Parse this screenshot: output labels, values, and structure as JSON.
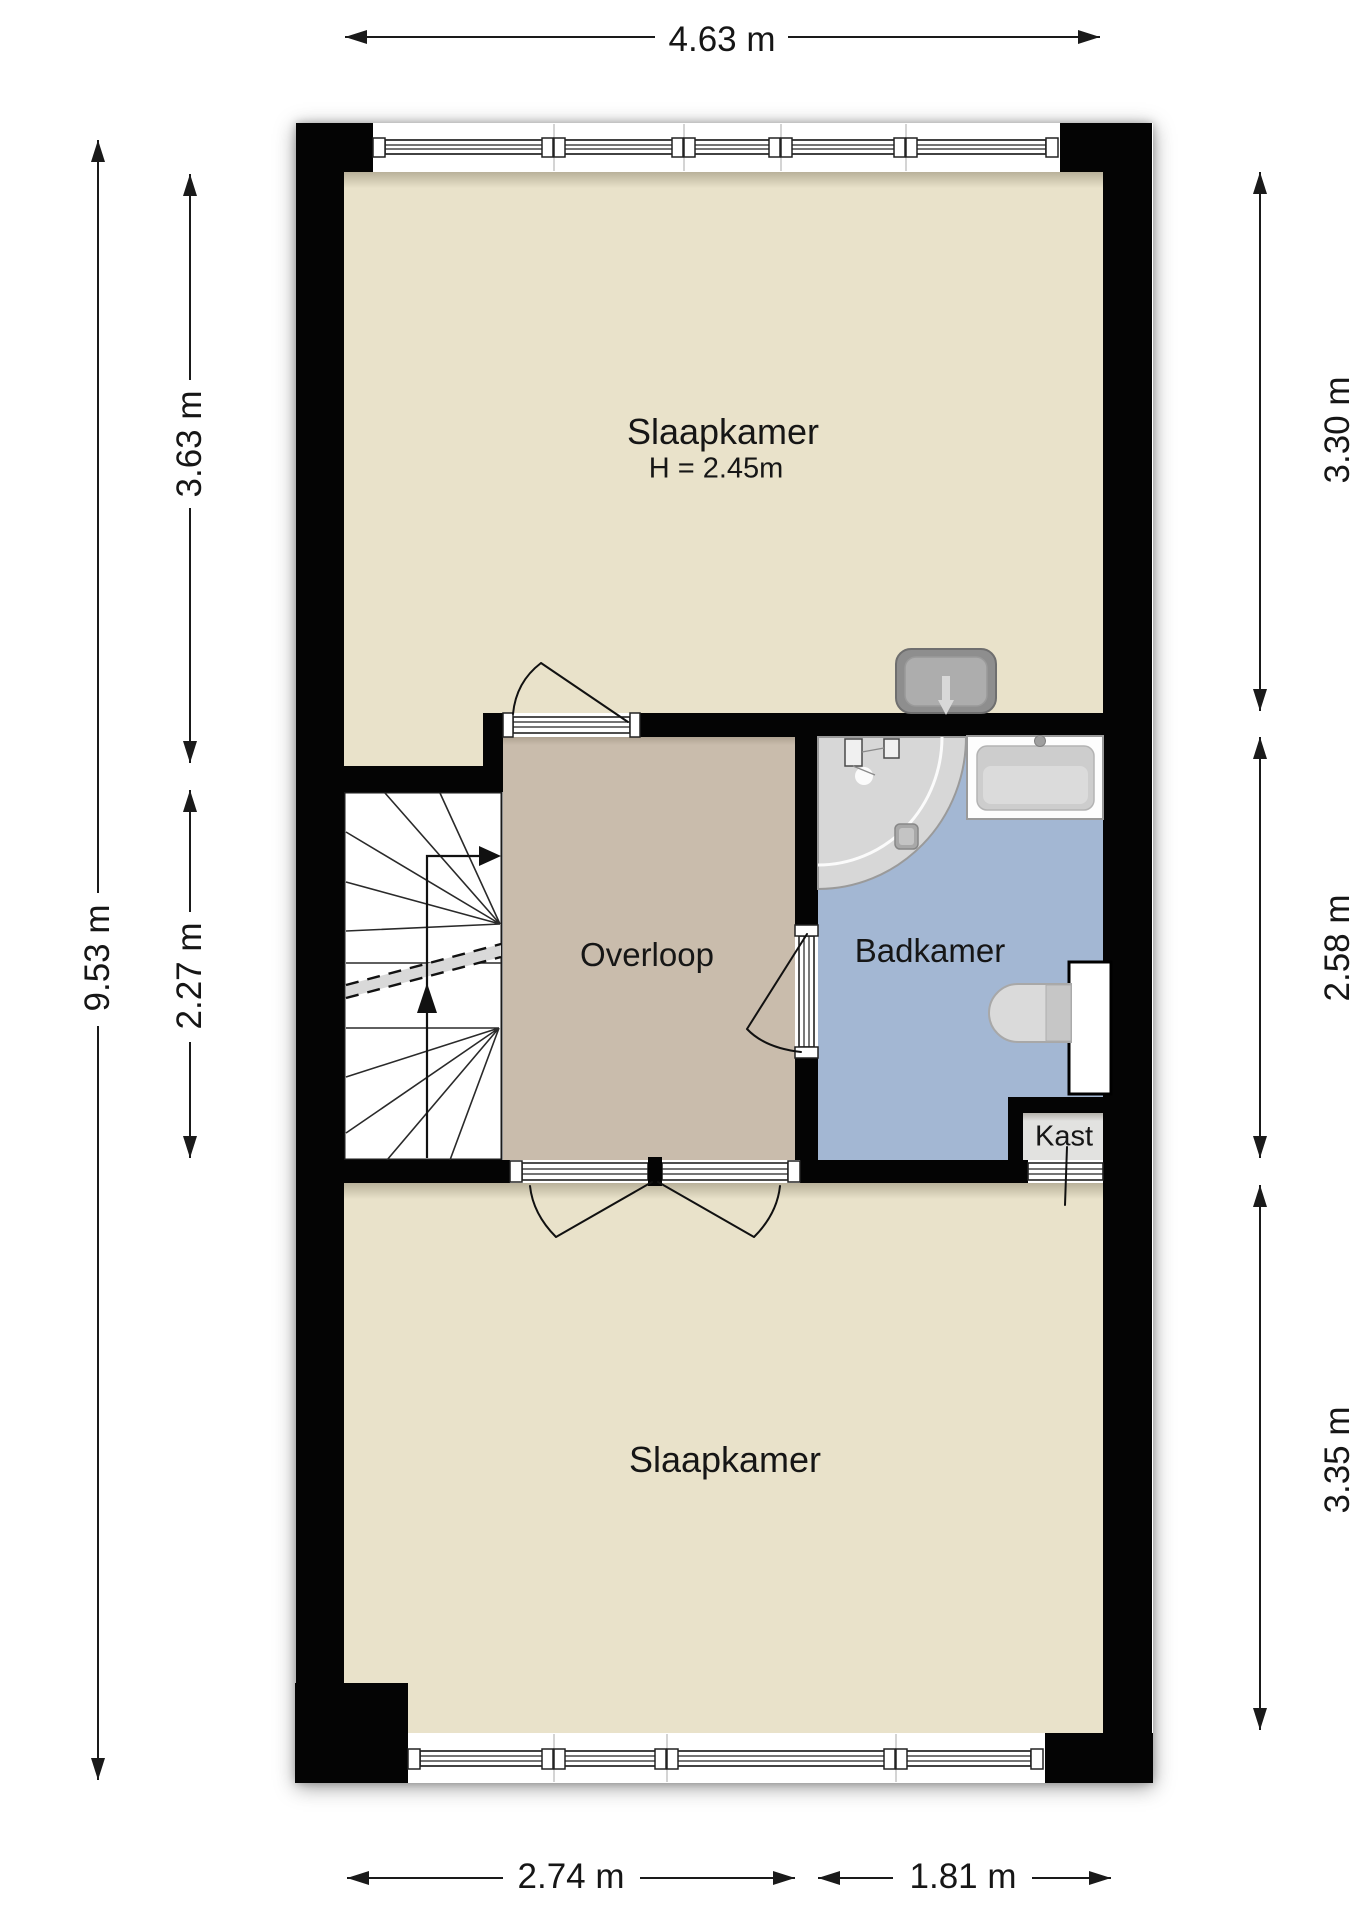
{
  "plan": {
    "rooms": {
      "slaapkamer_top": {
        "label": "Slaapkamer",
        "height_note": "H = 2.45m"
      },
      "overloop": {
        "label": "Overloop"
      },
      "badkamer": {
        "label": "Badkamer"
      },
      "kast": {
        "label": "Kast"
      },
      "slaapkamer_bottom": {
        "label": "Slaapkamer"
      }
    },
    "dimensions": {
      "top_width": "4.63 m",
      "left_total": "9.53 m",
      "left_upper": "3.63 m",
      "left_middle": "2.27 m",
      "right_upper": "3.30 m",
      "right_middle": "2.58 m",
      "right_lower": "3.35 m",
      "bottom_left": "2.74 m",
      "bottom_right": "1.81 m"
    },
    "colors": {
      "wall": "#000000",
      "floor_bedroom": "#e9e2ca",
      "floor_landing": "#c9bcac",
      "floor_bathroom": "#a3b7d3",
      "floor_closet": "#e2e2e0",
      "background": "#ffffff"
    }
  }
}
